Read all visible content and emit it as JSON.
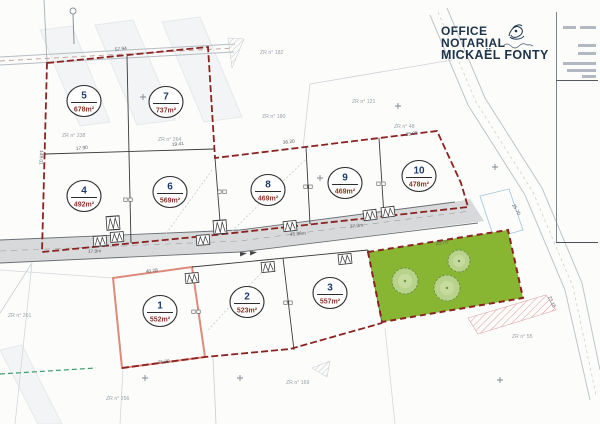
{
  "logo": {
    "line1": "OFFICE",
    "line2": "NOTARIAL",
    "line3": "MICKAËL FONTY"
  },
  "plan": {
    "lots": [
      {
        "id": "1",
        "area": "552m²",
        "cx": 160,
        "cy": 311
      },
      {
        "id": "2",
        "area": "523m²",
        "cx": 247,
        "cy": 302
      },
      {
        "id": "3",
        "area": "557m²",
        "cx": 330,
        "cy": 293
      },
      {
        "id": "4",
        "area": "492m²",
        "cx": 84,
        "cy": 196
      },
      {
        "id": "5",
        "area": "678m²",
        "cx": 84,
        "cy": 101
      },
      {
        "id": "6",
        "area": "569m²",
        "cx": 170,
        "cy": 192
      },
      {
        "id": "7",
        "area": "737m²",
        "cx": 166,
        "cy": 102
      },
      {
        "id": "8",
        "area": "469m²",
        "cx": 268,
        "cy": 190
      },
      {
        "id": "9",
        "area": "469m²",
        "cx": 345,
        "cy": 183
      },
      {
        "id": "10",
        "area": "478m²",
        "cx": 419,
        "cy": 176
      }
    ],
    "parcel_labels": [
      {
        "text": "ZR n° 238",
        "x": 62,
        "y": 137
      },
      {
        "text": "ZR n° 264",
        "x": 158,
        "y": 141
      },
      {
        "text": "ZR n° 182",
        "x": 260,
        "y": 54
      },
      {
        "text": "ZR n° 180",
        "x": 262,
        "y": 118
      },
      {
        "text": "ZR n° 121",
        "x": 352,
        "y": 103
      },
      {
        "text": "ZR n° 48",
        "x": 394,
        "y": 128
      },
      {
        "text": "ZR n° 261",
        "x": 8,
        "y": 317
      },
      {
        "text": "ZR n° 256",
        "x": 106,
        "y": 400
      },
      {
        "text": "ZR n° 169",
        "x": 286,
        "y": 384
      },
      {
        "text": "ZR n° 55",
        "x": 512,
        "y": 338
      }
    ],
    "dimension_labels": [
      {
        "text": "57.94",
        "x": 115,
        "y": 51,
        "rot": -6
      },
      {
        "text": "17.90",
        "x": 76,
        "y": 150,
        "rot": -5
      },
      {
        "text": "19.41",
        "x": 172,
        "y": 146,
        "rot": -5
      },
      {
        "text": "36.20",
        "x": 283,
        "y": 144,
        "rot": -7
      },
      {
        "text": "25.88",
        "x": 406,
        "y": 136,
        "rot": -8
      },
      {
        "text": "45.36m",
        "x": 290,
        "y": 236,
        "rot": -5
      },
      {
        "text": "27.3m",
        "x": 350,
        "y": 228,
        "rot": -6
      },
      {
        "text": "25.76",
        "x": 436,
        "y": 245,
        "rot": -8
      },
      {
        "text": "17.9m",
        "x": 88,
        "y": 253,
        "rot": -3
      },
      {
        "text": "40.28",
        "x": 146,
        "y": 273,
        "rot": -6
      },
      {
        "text": "25.39",
        "x": 158,
        "y": 364,
        "rot": -7
      },
      {
        "text": "149.01",
        "x": 40,
        "y": 150,
        "rot": 92
      },
      {
        "text": "25.70",
        "x": 512,
        "y": 205,
        "rot": 60
      },
      {
        "text": "23.15",
        "x": 548,
        "y": 297,
        "rot": 65
      }
    ],
    "trees": [
      {
        "cx": 405,
        "cy": 281,
        "r": 13
      },
      {
        "cx": 447,
        "cy": 288,
        "r": 13
      },
      {
        "cx": 459,
        "cy": 261,
        "r": 11
      }
    ],
    "gate_symbols": [
      {
        "x": 100,
        "y": 241,
        "r": -4
      },
      {
        "x": 117,
        "y": 237,
        "r": -4
      },
      {
        "x": 113,
        "y": 223,
        "r": -4,
        "tall": true
      },
      {
        "x": 203,
        "y": 240,
        "r": -4
      },
      {
        "x": 220,
        "y": 227,
        "r": -4,
        "tall": true
      },
      {
        "x": 290,
        "y": 226,
        "r": -6
      },
      {
        "x": 370,
        "y": 215,
        "r": -7
      },
      {
        "x": 388,
        "y": 212,
        "r": -7
      },
      {
        "x": 345,
        "y": 259,
        "r": -6
      },
      {
        "x": 268,
        "y": 267,
        "r": -5
      },
      {
        "x": 192,
        "y": 278,
        "r": -5
      }
    ],
    "boundary_stones": [
      {
        "x": 128,
        "y": 200
      },
      {
        "x": 222,
        "y": 192
      },
      {
        "x": 308,
        "y": 187
      },
      {
        "x": 381,
        "y": 184
      },
      {
        "x": 196,
        "y": 312
      },
      {
        "x": 288,
        "y": 303
      }
    ],
    "crosses": [
      {
        "x": 143,
        "y": 97
      },
      {
        "x": 320,
        "y": 178
      },
      {
        "x": 398,
        "y": 106
      },
      {
        "x": 495,
        "y": 167
      },
      {
        "x": 145,
        "y": 378
      },
      {
        "x": 240,
        "y": 378
      },
      {
        "x": 500,
        "y": 380
      }
    ],
    "colors": {
      "boundary_red": "#8b2222",
      "lot1_outline": "#de8a7d",
      "lot_number_blue": "#1c3a6e",
      "lot_area_red": "#8a3428",
      "green_space": "#88b633",
      "tree_fill": "#b9d28b",
      "road_gray": "#d8d9da",
      "logo_navy": "#1d3349"
    }
  }
}
